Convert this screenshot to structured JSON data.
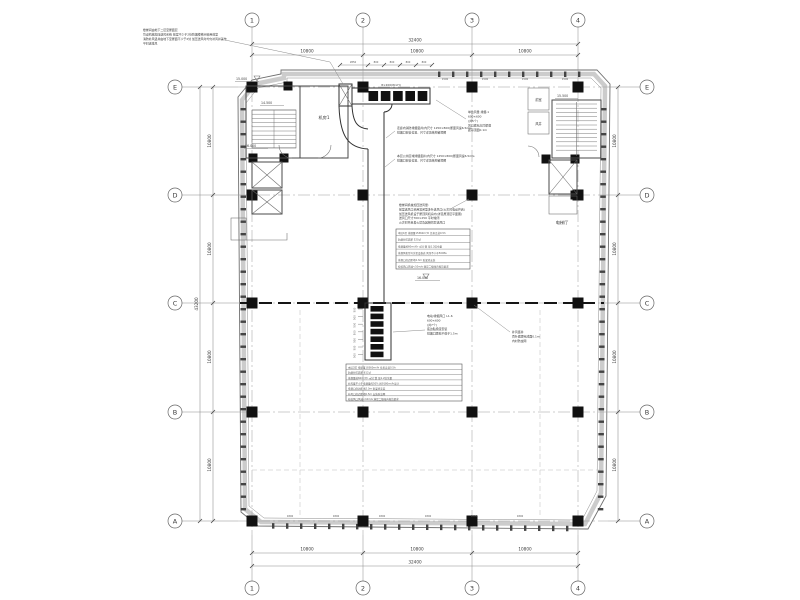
{
  "drawing": {
    "background": "#ffffff",
    "line_color": "#3a3a3a",
    "wall_band_color": "#cccccc",
    "column_color": "#111111"
  },
  "grid": {
    "cols": [
      "1",
      "2",
      "3",
      "4"
    ],
    "rows": [
      "E",
      "D",
      "C",
      "B",
      "A"
    ]
  },
  "dims": {
    "total_width": "32400",
    "bay_width": "10800",
    "total_height": "43200",
    "bay_height": "10800",
    "mini": [
      "2850",
      "800",
      "800",
      "800",
      "800"
    ],
    "window_top": "1500",
    "window_bottom": "1800",
    "louver_step": "500"
  },
  "labels": {
    "fan_room": "机房1",
    "elevator_hall": "电梯厅",
    "front_room": "前室",
    "air_shaft": "风井",
    "louver_size": "8×200(W×H)"
  },
  "elevations": {
    "stair_top": "15.000",
    "stair_mid": "14.500",
    "stair_bottom": "16.000",
    "right_stair": "15.500",
    "hall": "16.000"
  },
  "notes": {
    "topleft": [
      "楼梯间由地下二层至屋面层",
      "均设机械加压送风系统 前室不少于2处防烟楼梯间合用前室",
      "消防补风竖井由地下至屋面不少于2处 加压送风时均匀补风并兼作",
      "平时送排风"
    ],
    "corridor": [
      "走廊内消防排烟竖井(内尺寸 1250×800)断面风速6.5m/s",
      "排烟口安装位置、尺寸详见结构留洞图"
    ],
    "public": [
      "本层公共区域排烟竖井(内尺寸 1250×800)断面风速6.5m/s",
      "排烟口安装位置、尺寸详见结构留洞图"
    ],
    "louver": [
      "单台风量 排烟-1",
      "600×600",
      "(共5个)",
      "风口底标高同梁底",
      "距吊顶面0.1m"
    ],
    "pressurize": [
      "楼梯间机械加压送风量:",
      "前室送风口采用常闭型多叶送风口(火灾时电动开启)",
      "加压送风机设于屋顶风机房内(详见屋顶层平面图)",
      "送风口尺寸700×250 平时常闭",
      "火灾时开启着火层及其相邻层送风口"
    ],
    "outlet": [
      "电动/排烟风口 L1-6",
      "600×600",
      "(共7个)",
      "底边贴梁底安装",
      "排烟口距地不低于1.5m"
    ],
    "makeup": [
      "补风竖井",
      "百叶底距完成面0.1m",
      "内衬防虫网"
    ]
  },
  "tables": {
    "zone1": [
      "本层1区 排烟量15360m³/h 负担走道0.5h",
      "防烟分区面积 520㎡",
      "排烟量按60m³/(h·㎡)计算 取1.2倍余量",
      "排烟风机型号详见设备表 风压不小于500Pa",
      "排烟口底边距地2.3m 贴梁底安装",
      "校核风口风速<10m/s 满足二级噪声规范要求"
    ],
    "zone2": [
      "本层2区 排烟量18360m³/h 负担走道0.5h",
      "防烟分区面积 612㎡",
      "排烟量按60m³/(h·㎡)计算 取1.2倍余量",
      "补风量不小于排烟量的50% 按9180m³/h设计",
      "排烟口底边距地2.3m 贴梁底安装",
      "补风口底边距地0.5m 安装防虫网",
      "校核风口风速<10m/s 满足二级噪声规范要求"
    ]
  }
}
